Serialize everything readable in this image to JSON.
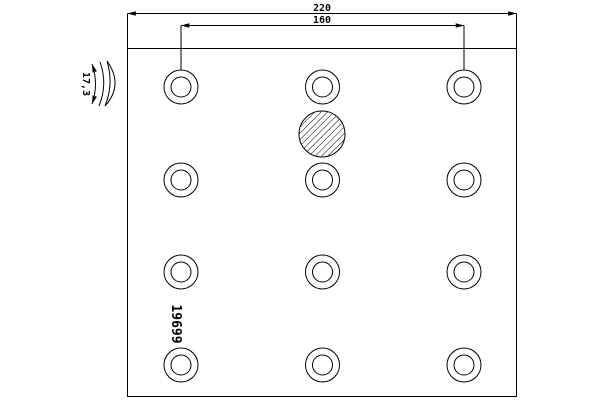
{
  "drawing": {
    "background_color": "#ffffff",
    "line_color": "#000000",
    "dimension_overall_width": "220",
    "dimension_hole_span": "160",
    "dimension_thickness": "17,3",
    "part_number": "19699",
    "holes": {
      "rows": 4,
      "cols": 3,
      "count": 12,
      "col_x": [
        181,
        322.5,
        464
      ],
      "row_y": [
        87,
        180,
        272,
        365
      ],
      "outer_radius": 17,
      "inner_radius": 10
    },
    "hatched_circle": {
      "cx": 322,
      "cy": 134,
      "r": 23
    }
  }
}
